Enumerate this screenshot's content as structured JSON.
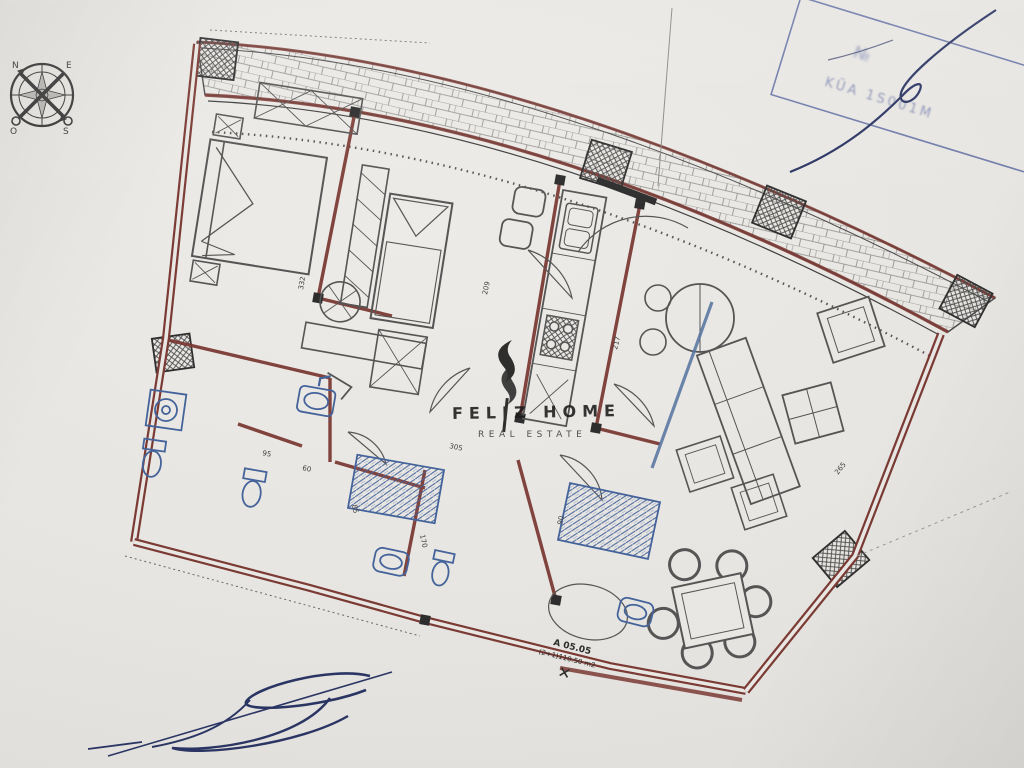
{
  "compass": {
    "n": "N",
    "e": "E",
    "s": "S",
    "w": "O"
  },
  "watermark": {
    "brand": "FELIZ HOME",
    "tagline": "REAL ESTATE"
  },
  "stamp": {
    "line1": "№",
    "line2": "KÜA 1S001M"
  },
  "unit_label": {
    "line1": "A 05.05",
    "line2": "(2+1)110.50 m2"
  },
  "dimensions": {
    "d1": "332",
    "d2": "209",
    "d3": "217",
    "d4": "305",
    "d5": "170",
    "d6": "85",
    "d7": "95",
    "d8": "60",
    "d9": "90",
    "d10": "265"
  },
  "colors": {
    "paper": "#e9e7e3",
    "wall": "#7b3a34",
    "ink": "#4a4a4a",
    "fixture_blue": "#44639a",
    "stamp_blue": "#51619c",
    "signature_blue": "#2a3563"
  }
}
